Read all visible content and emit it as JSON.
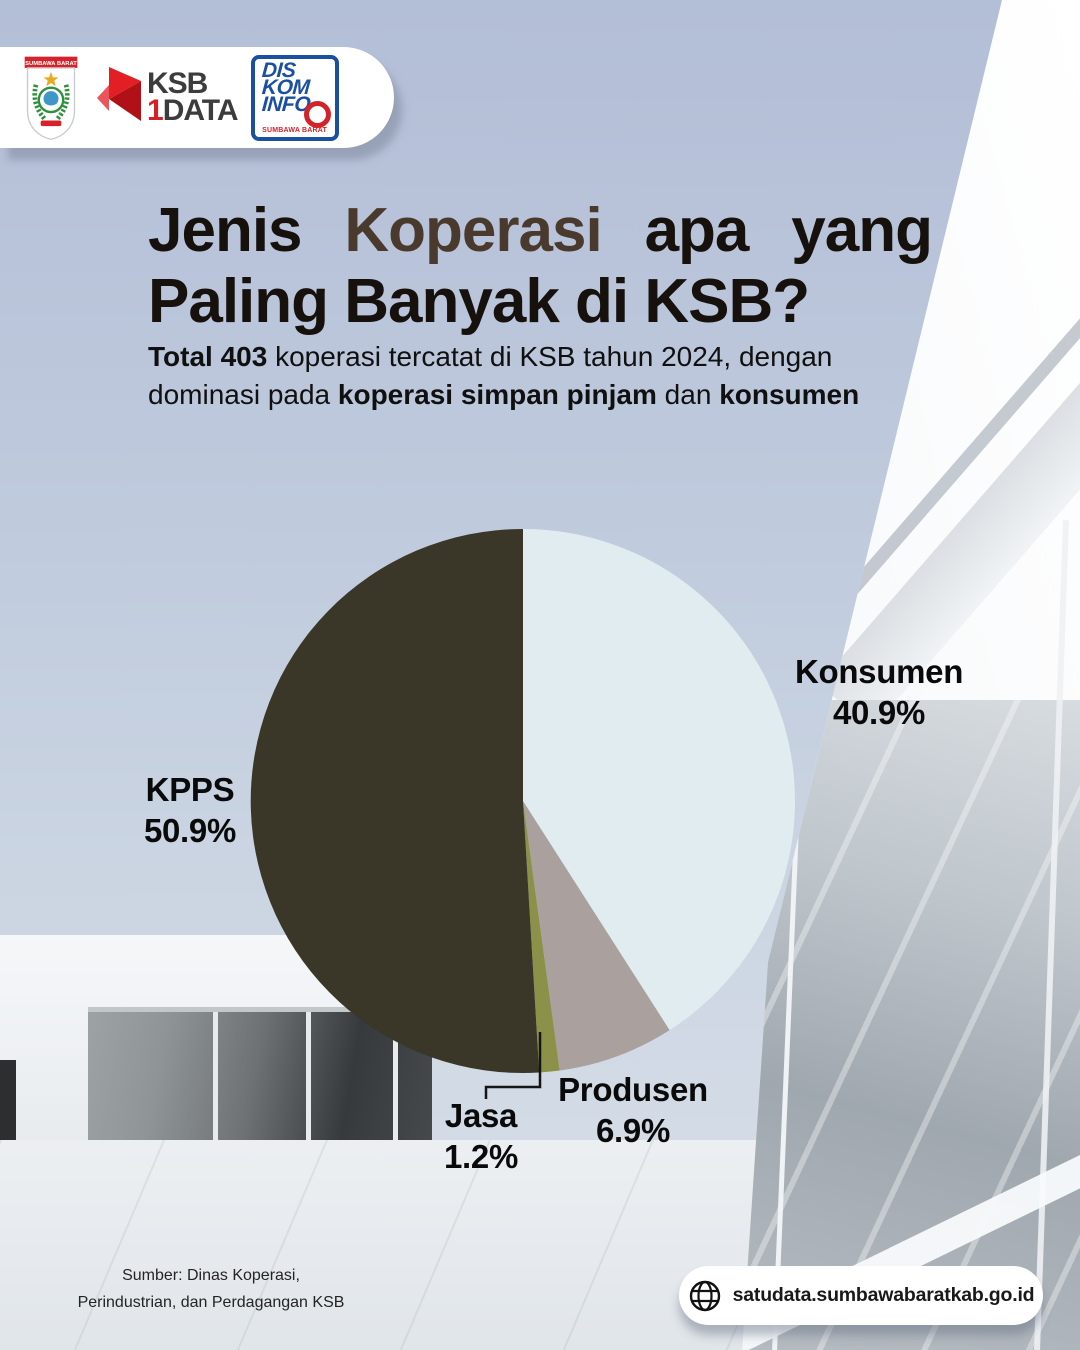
{
  "header": {
    "emblem": {
      "banner": "SUMBAWA BARAT"
    },
    "ksb_satu_data": {
      "line1": "KSB",
      "digit": "1",
      "line2": "DATA"
    },
    "diskominfo": {
      "line1": "DIS",
      "line2": "KOM",
      "line3": "INFO",
      "subtext": "SUMBAWA BARAT"
    }
  },
  "title": {
    "line1_words": [
      {
        "text": "Jenis",
        "highlight": false
      },
      {
        "text": "Koperasi",
        "highlight": true
      },
      {
        "text": "apa",
        "highlight": false
      },
      {
        "text": "yang",
        "highlight": false
      }
    ],
    "line2": "Paling Banyak di KSB?",
    "highlight_color": "#4a3a2d"
  },
  "subtitle": {
    "segments": [
      {
        "text": "Total 403 ",
        "bold": true
      },
      {
        "text": "koperasi tercatat di KSB tahun 2024, dengan",
        "bold": false
      },
      {
        "br": true
      },
      {
        "text": "dominasi pada ",
        "bold": false
      },
      {
        "text": "koperasi simpan pinjam",
        "bold": true
      },
      {
        "text": " dan ",
        "bold": false
      },
      {
        "text": "konsumen",
        "bold": true
      }
    ]
  },
  "chart_data": {
    "type": "pie",
    "title": "",
    "total_koperasi": 403,
    "year": 2024,
    "direction": "clockwise",
    "start_angle_deg_from_top": 0,
    "legend_position": "labels-around-pie",
    "slices": [
      {
        "label": "Konsumen",
        "value": 40.9,
        "pct_label": "40.9%",
        "color": "#e1ecf0"
      },
      {
        "label": "Produsen",
        "value": 6.9,
        "pct_label": "6.9%",
        "color": "#aaa19f"
      },
      {
        "label": "Jasa",
        "value": 1.2,
        "pct_label": "1.2%",
        "color": "#8b9148"
      },
      {
        "label": "KPPS",
        "value": 50.9,
        "pct_label": "50.9%",
        "color": "#3a3628"
      }
    ]
  },
  "source": {
    "line1": "Sumber: Dinas Koperasi,",
    "line2": "Perindustrian, dan Perdagangan KSB"
  },
  "footer": {
    "url": "satudata.sumbawabaratkab.go.id"
  }
}
